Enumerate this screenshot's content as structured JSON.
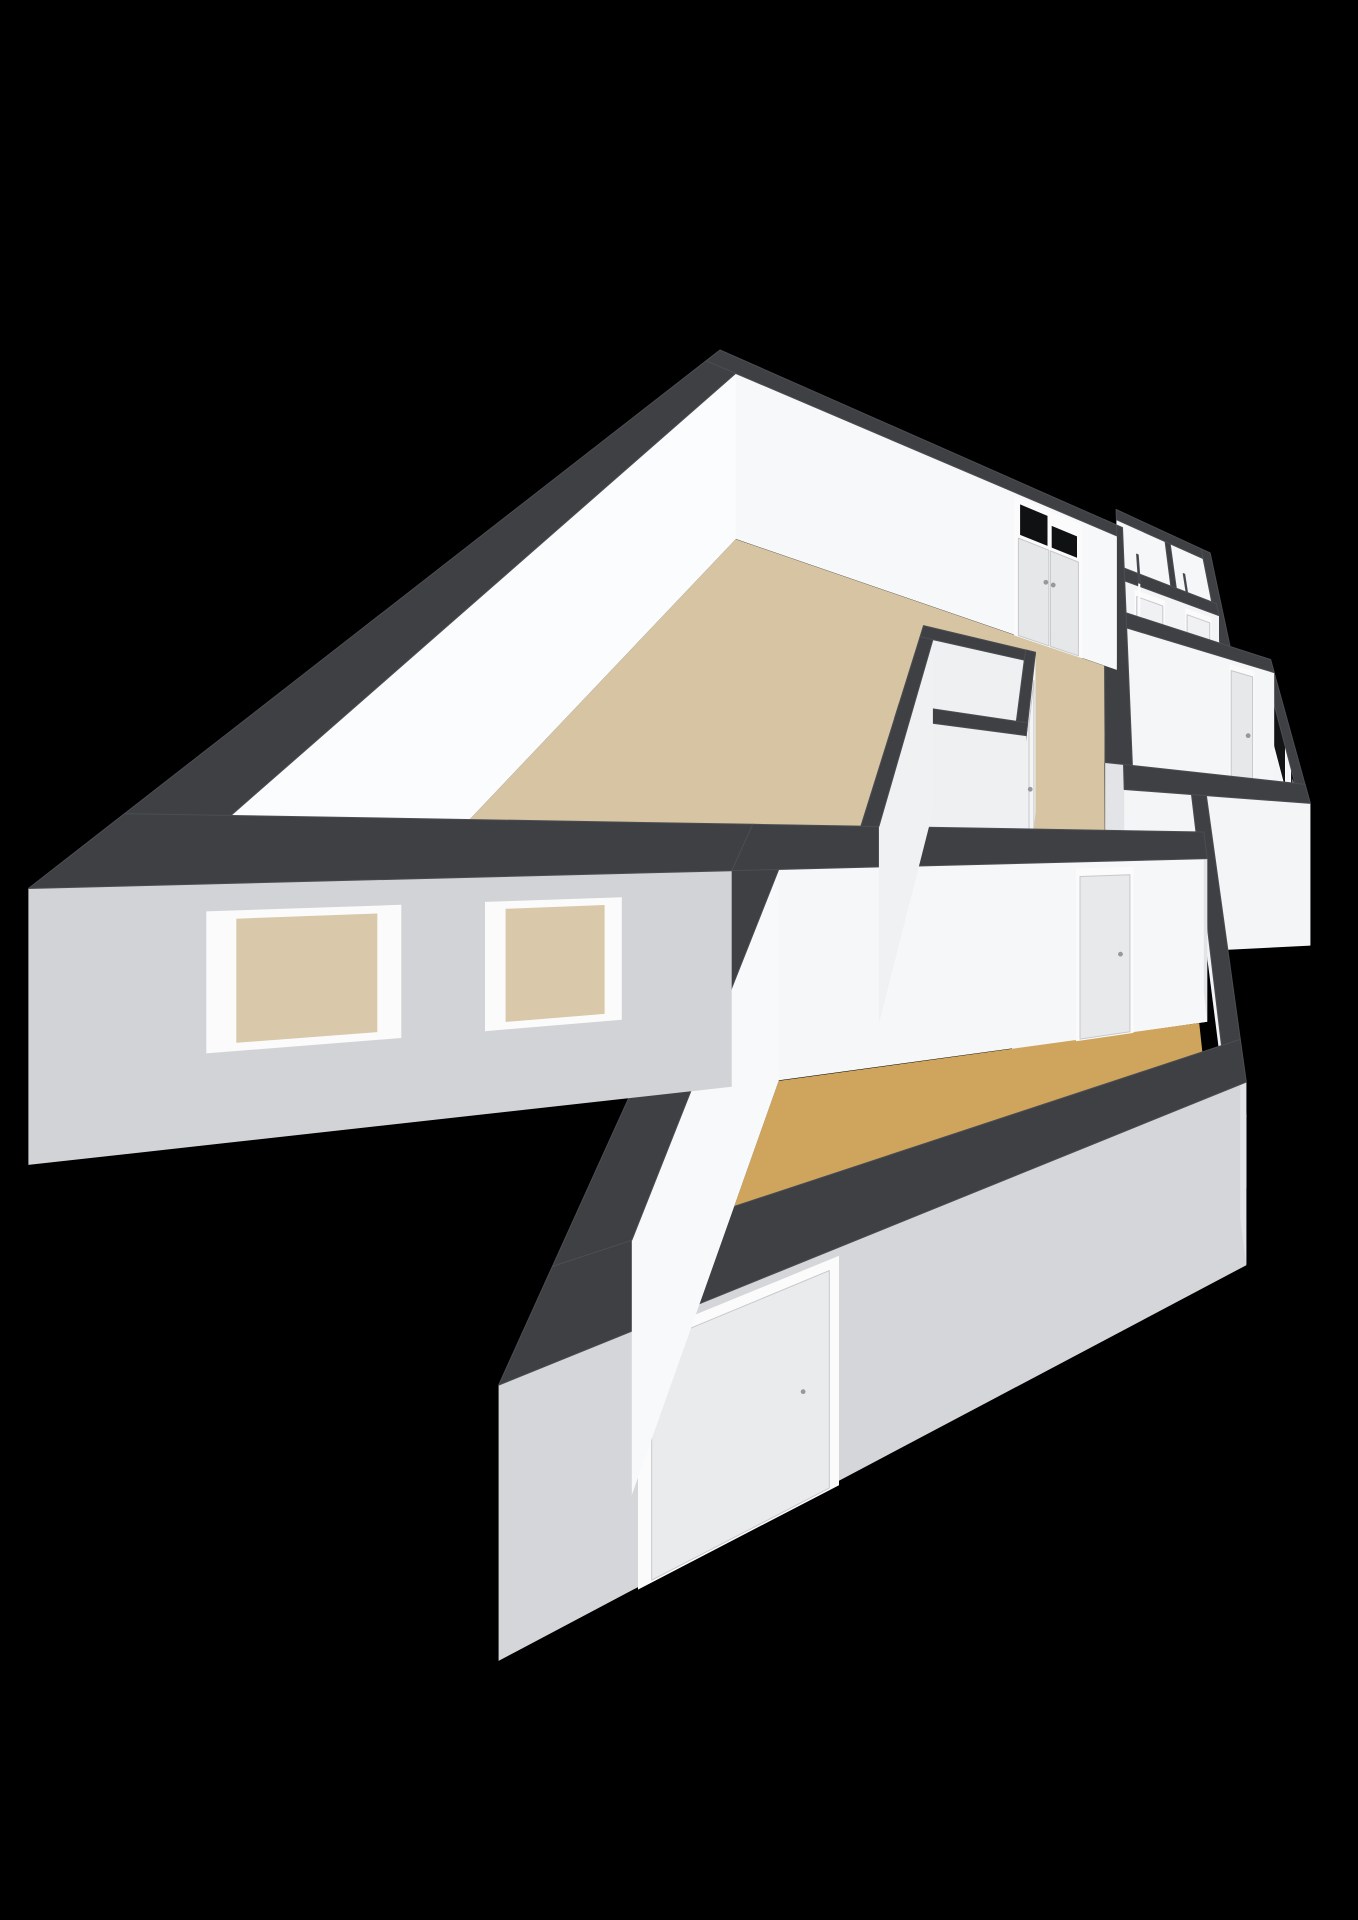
{
  "scene": {
    "background": "#000000",
    "wall_cap_color": "#3e4044",
    "cap_edge_color": "#4b4d52",
    "end_face_color": "#e2e4e7",
    "frame_color": "#fbfbfc",
    "panel_seam_color": "#c7c8cc",
    "handle_color": "#97989c",
    "wall_height_m": 2.2
  },
  "rooms": [
    {
      "id": "floor-living-room",
      "color": "#d6c4a3",
      "poly": [
        [
          0.28,
          0.28
        ],
        [
          5.67,
          0.28
        ],
        [
          5.67,
          3.95
        ],
        [
          4.59,
          3.95
        ],
        [
          4.59,
          4.87
        ],
        [
          0.28,
          4.87
        ]
      ]
    },
    {
      "id": "floor-hall",
      "color": "#f4f4f6",
      "poly": [
        [
          6.09,
          1.26
        ],
        [
          8.27,
          1.26
        ],
        [
          8.27,
          1.9
        ],
        [
          6.09,
          1.9
        ]
      ]
    },
    {
      "id": "floor-storage-a",
      "color": "#ebebed",
      "poly": [
        [
          6.09,
          -0.14
        ],
        [
          7.18,
          -0.14
        ],
        [
          7.18,
          0.98
        ],
        [
          6.09,
          0.98
        ]
      ]
    },
    {
      "id": "floor-storage-b",
      "color": "#ebebed",
      "poly": [
        [
          7.32,
          -0.14
        ],
        [
          8.27,
          -0.14
        ],
        [
          8.27,
          0.98
        ],
        [
          7.32,
          0.98
        ]
      ]
    },
    {
      "id": "floor-bathroom",
      "color": "#b3c0d3",
      "poly": [
        [
          6.09,
          2.18
        ],
        [
          9.47,
          2.18
        ],
        [
          9.47,
          4.17
        ],
        [
          6.09,
          4.17
        ]
      ]
    },
    {
      "id": "floor-corridor",
      "color": "#f4f4f6",
      "poly": [
        [
          4.59,
          3.95
        ],
        [
          5.95,
          3.95
        ],
        [
          5.95,
          4.45
        ],
        [
          7.21,
          4.45
        ],
        [
          7.21,
          5.15
        ],
        [
          4.59,
          5.15
        ]
      ]
    },
    {
      "id": "floor-closet-a",
      "color": "#ececee",
      "poly": [
        [
          3.33,
          3.09
        ],
        [
          4.45,
          3.09
        ],
        [
          4.45,
          3.84
        ],
        [
          3.33,
          3.84
        ]
      ]
    },
    {
      "id": "floor-closet-b",
      "color": "#ececee",
      "poly": [
        [
          3.33,
          3.98
        ],
        [
          4.45,
          3.98
        ],
        [
          4.45,
          4.87
        ],
        [
          3.33,
          4.87
        ]
      ]
    },
    {
      "id": "floor-bedroom",
      "color": "#cfa55e",
      "poly": [
        [
          2.73,
          5.15
        ],
        [
          7.07,
          5.15
        ],
        [
          7.07,
          6.67
        ],
        [
          2.73,
          6.67
        ]
      ]
    }
  ],
  "walls": [
    {
      "id": "wall-annex-north",
      "rect": [
        5.95,
        -0.42,
        8.55,
        -0.14
      ],
      "south": "#f6f7f8"
    },
    {
      "id": "wall-annex-east",
      "rect": [
        8.27,
        -0.42,
        8.55,
        1.9
      ],
      "east": "#f4f5f7"
    },
    {
      "id": "wall-living-north",
      "rect": [
        0,
        0,
        5.95,
        0.28
      ],
      "south": "#f7f8f9",
      "endE": true,
      "openings": [
        {
          "type": "entry",
          "from": 3.95,
          "to": 5.15,
          "glass": "#101113",
          "panel": "#e6e7e9"
        }
      ]
    },
    {
      "id": "wall-closet-divider",
      "rect": [
        7.18,
        -0.14,
        7.32,
        0.98
      ],
      "east": "#f1f2f3"
    },
    {
      "id": "wall-closets-south",
      "rect": [
        6.09,
        0.98,
        8.41,
        1.26
      ],
      "south": "#f3f4f5",
      "openings": [
        {
          "type": "door",
          "from": 6.35,
          "to": 6.95,
          "panel": "#f0f1f3"
        },
        {
          "type": "door",
          "from": 7.55,
          "to": 8.15,
          "panel": "#f0f1f3"
        }
      ]
    },
    {
      "id": "door-leaf-storage-a",
      "rect": [
        6.41,
        0.3,
        6.45,
        0.98
      ],
      "east": "#fdfdfe",
      "h": 2.05
    },
    {
      "id": "door-leaf-storage-b",
      "rect": [
        7.61,
        0.3,
        7.65,
        0.98
      ],
      "east": "#fdfdfe",
      "h": 2.05
    },
    {
      "id": "wall-living-east",
      "rect": [
        5.67,
        0,
        6.09,
        4.17
      ],
      "east": "#eef0f2",
      "endS": true,
      "openings": [
        {
          "type": "passage",
          "from": 1.15,
          "to": 1.85,
          "fill": "#f1f1f2"
        }
      ]
    },
    {
      "id": "wall-bathroom-north",
      "rect": [
        5.95,
        1.9,
        9.75,
        2.18
      ],
      "south": "#f5f6f7",
      "openings": [
        {
          "type": "door",
          "from": 8.5,
          "to": 9.1,
          "panel": "#e7e8ea"
        }
      ]
    },
    {
      "id": "wall-closet-north",
      "rect": [
        3.19,
        2.95,
        4.59,
        3.09
      ],
      "south": "#eef0f1"
    },
    {
      "id": "wall-closet-west",
      "rect": [
        3.19,
        3.09,
        3.33,
        4.87
      ],
      "east": "#f0f1f3"
    },
    {
      "id": "wall-closet-mid",
      "rect": [
        3.19,
        3.84,
        4.59,
        3.98
      ],
      "south": "#eef0f1"
    },
    {
      "id": "wall-closet-east",
      "rect": [
        4.45,
        2.95,
        4.59,
        4.87
      ],
      "east": "#f0f1f3",
      "endS": true,
      "openings": [
        {
          "type": "door",
          "from": 3.15,
          "to": 3.7,
          "panel": "#f4f4f6"
        },
        {
          "type": "door",
          "from": 4.05,
          "to": 4.6,
          "panel": "#f4f4f6"
        }
      ]
    },
    {
      "id": "wall-bathroom-south",
      "rect": [
        5.95,
        4.17,
        9.75,
        4.45
      ],
      "south": "#f4f5f6"
    },
    {
      "id": "wall-bedroom-north",
      "rect": [
        2.45,
        4.87,
        7.21,
        5.15
      ],
      "south": "#f6f7f8",
      "endE": true,
      "openings": [
        {
          "type": "door",
          "from": 5.35,
          "to": 6.0,
          "panel": "#e8e9eb"
        }
      ]
    },
    {
      "id": "wall-bedroom-west",
      "rect": [
        2.45,
        5.15,
        2.73,
        6.67
      ],
      "east": "#f8f9fa"
    },
    {
      "id": "wall-bedroom-east",
      "rect": [
        7.07,
        4.45,
        7.35,
        6.67
      ],
      "east": "#f2f3f5",
      "openings": [
        {
          "type": "window",
          "from": 5.45,
          "to": 6.0,
          "z": [
            1.15,
            1.85
          ],
          "glass": "#0a0b0c"
        }
      ]
    },
    {
      "id": "wall-flue-bump",
      "rect": [
        7.35,
        6.08,
        7.5,
        6.5
      ],
      "east": "#eceff1",
      "south": "#c9cbce",
      "h": 0.9
    },
    {
      "id": "wall-bedroom-south",
      "rect": [
        2.45,
        6.67,
        7.35,
        6.95
      ],
      "south": "#d5d6d9",
      "endE": true,
      "openings": [
        {
          "type": "door",
          "from": 2.95,
          "to": 3.72,
          "panel": "#eaebed"
        }
      ]
    },
    {
      "id": "wall-living-south",
      "rect": [
        0,
        4.87,
        2.45,
        5.15
      ],
      "south": "#d2d3d6",
      "openings": [
        {
          "type": "window",
          "from": 0.5,
          "to": 0.92,
          "z": [
            0.85,
            1.9
          ],
          "glass": "#d9c8a9"
        },
        {
          "type": "window",
          "from": 1.38,
          "to": 1.8,
          "z": [
            0.85,
            1.9
          ],
          "glass": "#d9c8a9"
        }
      ]
    },
    {
      "id": "wall-living-west",
      "rect": [
        0,
        0.28,
        0.28,
        4.87
      ],
      "east": "#fbfcfd"
    },
    {
      "id": "wall-bathroom-east",
      "rect": [
        9.47,
        1.9,
        9.75,
        4.45
      ],
      "east": "#f4f5f7",
      "openings": [
        {
          "type": "window",
          "from": 2.15,
          "to": 2.95,
          "z": [
            0.95,
            2.05
          ],
          "glass": "#121315"
        },
        {
          "type": "window",
          "from": 3.35,
          "to": 4.05,
          "z": [
            0.7,
            1.9
          ],
          "glass": "#0b0b0d",
          "washer": true
        }
      ]
    }
  ],
  "washer": {
    "body": "#d3d4d6",
    "drum": "#2b2c2e",
    "ring": "#ebebec",
    "latch": "#dddddf"
  }
}
